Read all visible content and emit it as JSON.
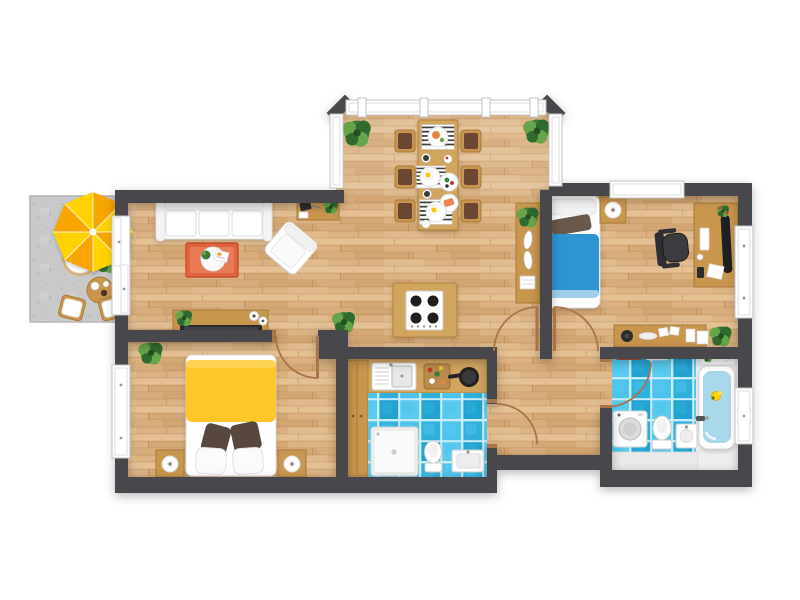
{
  "scene": {
    "type": "apartment-floor-plan-top-view",
    "background": "#ffffff",
    "wall_style": "dark-gray",
    "floor_style": "light-oak-plank"
  },
  "palette": {
    "wall": "#48484c",
    "wood1": "#dcb282",
    "wood2": "#d2a572",
    "wood3": "#e4c093",
    "furnWood": "#c9964e",
    "furnWoodDark": "#a87a39",
    "counterWood": "#d2a55e",
    "balcony": "#c9c9c9",
    "tile1": "#2fb0dc",
    "tile2": "#4cc3ea",
    "tile3": "#23a2d0",
    "tile4": "#5ccaee",
    "grout": "#c8edf9",
    "rug": "#e0643f",
    "rugInner": "#e87a55",
    "bedYellow": "#ffc629",
    "bedBlue": "#2f95d0",
    "umbA": "#ffd200",
    "umbB": "#f7a600",
    "plantDark": "#2f6b2e",
    "plant": "#3c7d37",
    "plantLight": "#67a54b",
    "doorArc": "#a9744a",
    "chairSeat": "#6b4632",
    "water": "#a8d8ea",
    "dark": "#2c2c2f"
  },
  "rooms": [
    {
      "id": "balcony",
      "label": "Balcony",
      "floor": "concrete",
      "items": [
        "parasol-yellow-orange",
        "round-lounge-chair",
        "side-table-with-cups",
        "bistro-chair",
        "bistro-chair",
        "potted-plant"
      ]
    },
    {
      "id": "living-room",
      "label": "Living room",
      "floor": "wood",
      "items": [
        "three-seat-sofa",
        "orange-rug",
        "round-coffee-table",
        "magazine",
        "small-plant",
        "armchair",
        "writing-desk",
        "tv-sideboard",
        "flat-tv",
        "speakers",
        "potted-plant",
        "sliding-balcony-door"
      ]
    },
    {
      "id": "dining-bay",
      "label": "Dining bay",
      "floor": "wood",
      "items": [
        "dining-table",
        "chair",
        "chair",
        "chair",
        "chair",
        "chair",
        "chair",
        "striped-placemat",
        "striped-placemat",
        "striped-placemat",
        "plates-with-food",
        "potted-plant",
        "potted-plant",
        "panorama-windows"
      ]
    },
    {
      "id": "kitchen",
      "label": "Kitchen nook",
      "floor": "wood",
      "items": [
        "island-with-four-burner-cooktop",
        "counter",
        "sink-with-drainer",
        "cutting-board-with-food",
        "frying-pan",
        "tall-cabinet"
      ]
    },
    {
      "id": "bedroom-left",
      "label": "Bedroom (double)",
      "floor": "wood",
      "items": [
        "double-bed-yellow-blanket",
        "brown-pillow",
        "brown-pillow",
        "white-pillow",
        "white-pillow",
        "nightstand-with-lamp",
        "nightstand-with-lamp",
        "potted-plant",
        "window"
      ]
    },
    {
      "id": "bedroom-right",
      "label": "Bedroom / office",
      "floor": "wood",
      "items": [
        "single-bed-blue-blanket",
        "brown-pillow",
        "nightstand-with-lamp",
        "console-with-plant-and-dishes",
        "desk-with-monitor-and-keyboard",
        "office-chair",
        "decor-sideboard",
        "potted-plant",
        "window",
        "window"
      ]
    },
    {
      "id": "shower-room",
      "label": "Shower room",
      "floor": "blue-tile",
      "items": [
        "shower-cabin",
        "toilet",
        "wall-hung-sink"
      ]
    },
    {
      "id": "bathroom",
      "label": "Bathroom",
      "floor": "blue-tile",
      "items": [
        "bathtub-with-duck",
        "toiletry-shelf",
        "washing-machine",
        "toilet",
        "sink",
        "towel-rail",
        "window"
      ]
    },
    {
      "id": "hallway",
      "label": "Hallway",
      "floor": "wood",
      "items": [
        "door-swing-arcs"
      ]
    }
  ],
  "counts": {
    "rooms": 9,
    "door_swings": 5,
    "sliding_doors": 1,
    "windows": 8,
    "dining_chairs": 6
  }
}
